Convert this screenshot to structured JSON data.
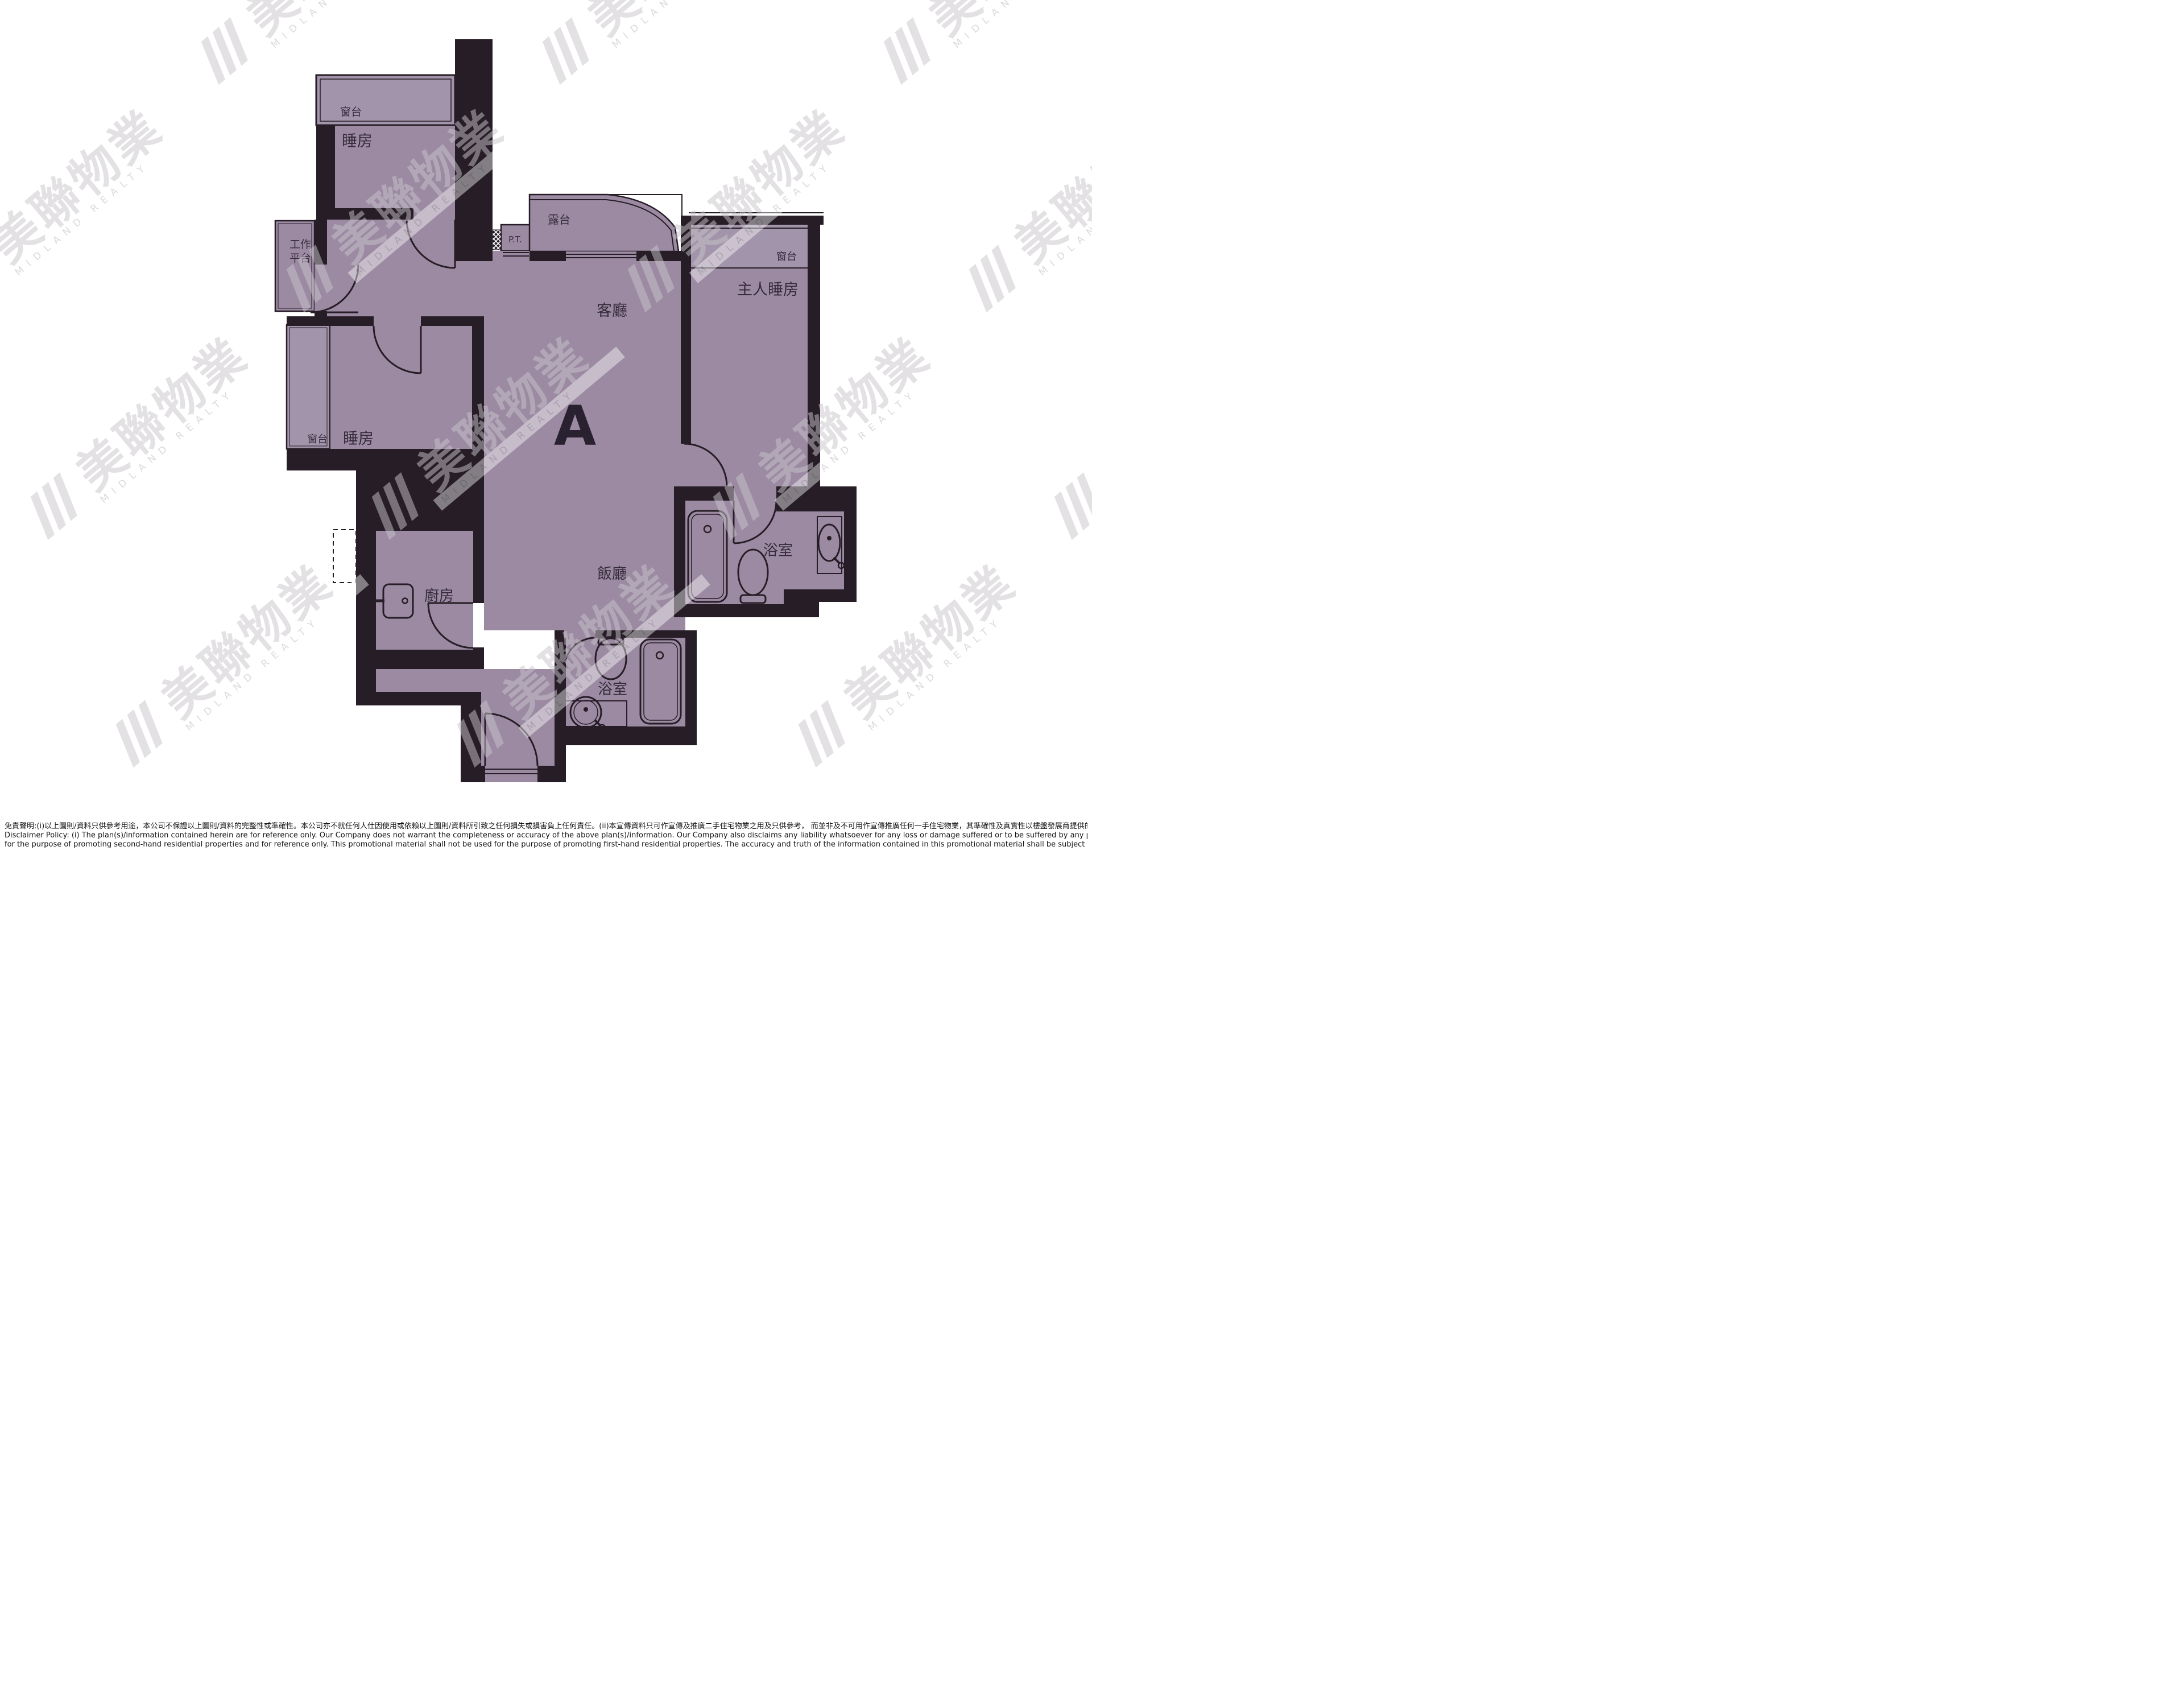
{
  "unit": {
    "label": "A"
  },
  "labels": {
    "bay_window_top": "窗台",
    "bedroom_top": "睡房",
    "utility_line1": "工作",
    "utility_line2": "平台",
    "balcony": "露台",
    "pipe_duct": "P.T.",
    "living_room": "客廳",
    "bay_window_master": "窗台",
    "master_bedroom": "主人睡房",
    "bay_window_left": "窗台",
    "bedroom_left": "睡房",
    "dining_room": "飯廳",
    "bathroom_ensuite": "浴室",
    "kitchen": "廚房",
    "bathroom": "浴室"
  },
  "watermark": {
    "cjk": "美聯物業",
    "en": "MIDLAND REALTY"
  },
  "disclaimer": {
    "line_zh": "免責聲明:(i)以上圖則/資料只供參考用途，本公司不保證以上圖則/資料的完整性或準確性。本公司亦不就任何人仕因使用或依賴以上圖則/資料所引致之任何損失或損害負上任何責任。(ii)本宣傳資料只可作宣傳及推廣二手住宅物業之用及只供參考， 而並非及不可用作宣傳推廣任何一手住宅物業，其準確性及真實性以樓盤發展商提供的資料為準。",
    "line_en_1": "Disclaimer Policy: (i) The plan(s)/information contained herein are for reference only. Our Company does not warrant the completeness or accuracy of the above plan(s)/information. Our Company also disclaims any liability whatsoever for any loss or damage suffered or to be suffered by any person as a result of using or relying on the plan(s)/information. (ii) This promotional material is",
    "line_en_2": "for the purpose of promoting second-hand residential properties and for reference only. This promotional material shall not be used for the purpose of promoting first-hand residential properties. The accuracy and truth of the information contained in this promotional material shall be subject to information provided by the developers."
  },
  "colors": {
    "room_fill": "#9c8aa3",
    "bay_fill": "#a294aa",
    "wall": "#261d26",
    "label_text": "#352b3a",
    "watermark_gray": "#c9c5cb"
  }
}
